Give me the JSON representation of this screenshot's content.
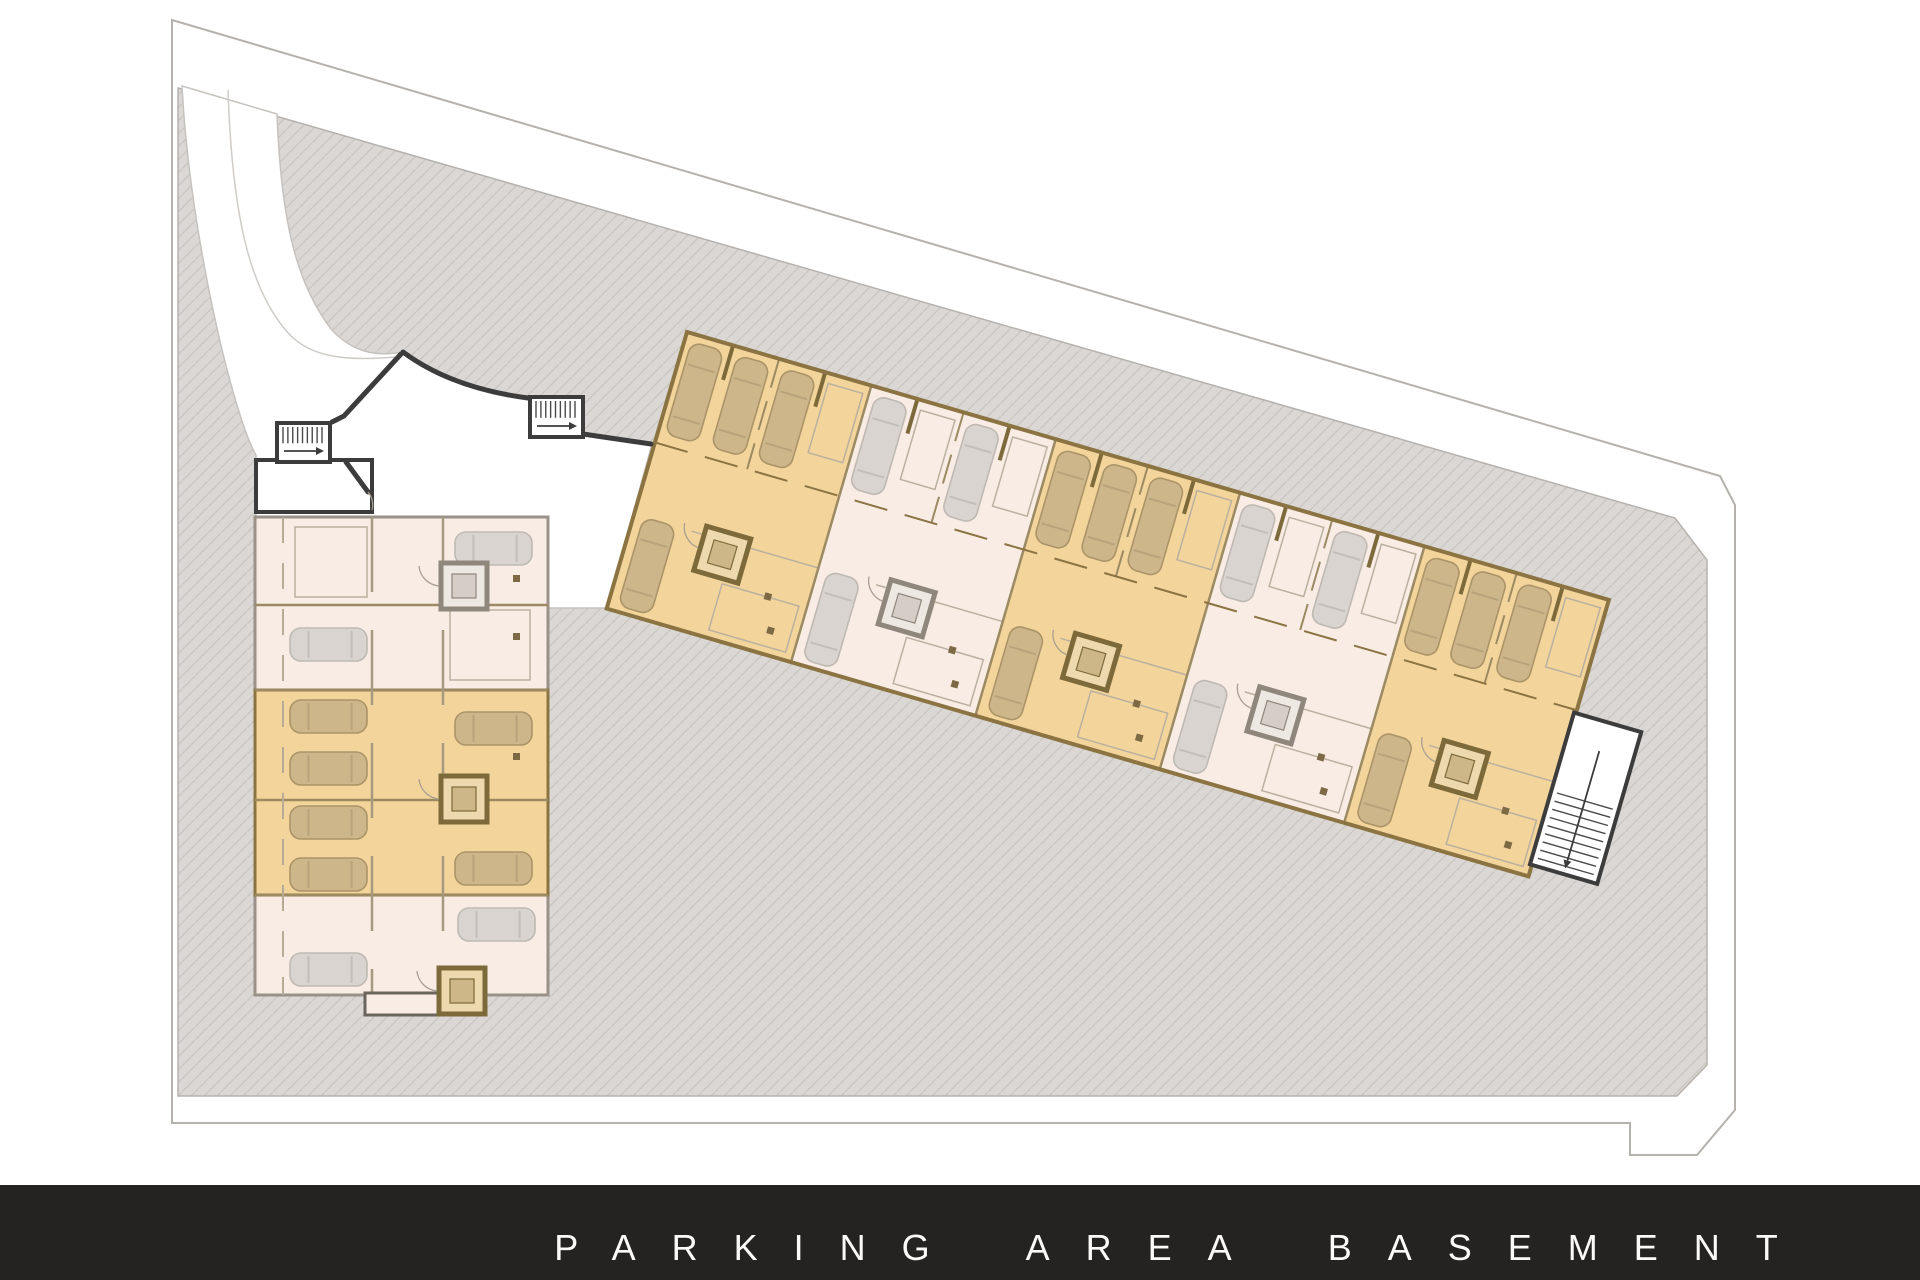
{
  "footer": {
    "title": "PARKING AREA BASEMENT"
  },
  "palette": {
    "boundary_line": "#b5b2ae",
    "site_base": "#dad7d4",
    "hatch_line": "#c9c6c2",
    "wall_dark": "#3c3c3c",
    "wall_tan": "#8b7442",
    "wall_gray": "#9a9189",
    "unit_orange": "#f3d49b",
    "unit_pink": "#f8ece4",
    "car_tan": "#cdb68a",
    "car_gray": "#d9d4cf",
    "footer_bg": "#242321",
    "footer_text": "#fafafa"
  },
  "plan": {
    "canvas": {
      "w": 1920,
      "h": 1280
    },
    "boundary_path": "M172,20 L1720,476 L1735,505 L1735,1110 L1697,1155 L1630,1155 L1630,1123 L172,1123 Z",
    "site_path": "M178,88 L1675,518 L1707,560 L1707,1065 L1677,1096 L178,1096 Z",
    "white_area_path": "M182,86 L277,114 C281,220 296,283 331,329 C352,352 375,357 403,352 C440,379 484,392 530,398 L583,434 L652,444 L607,608 L548,608 L548,517 L256,517 L256,455 C235,420 190,240 182,86 Z",
    "driveway_center_line": "M228,90 C232,210 248,290 290,335 C310,355 340,362 395,357",
    "walls_dark": [
      "M401,354 L344,416 L332,422",
      "M403,352 C438,378 482,392 528,398",
      "M583,434 L651,444"
    ],
    "entry_room": {
      "x": 256,
      "y": 460,
      "w": 116,
      "h": 52,
      "slant": "M346,462 L368,492",
      "door_arc": "M368,492 A20,20 0 0 1 372,510"
    },
    "stair_rooms": [
      {
        "x": 277,
        "y": 423,
        "w": 53,
        "h": 39
      },
      {
        "x": 530,
        "y": 397,
        "w": 53,
        "h": 40
      }
    ],
    "west_building": {
      "x": 255,
      "y": 517,
      "w": 293,
      "h": 478,
      "orange_band": {
        "y": 690,
        "h": 205
      },
      "row_lines": [
        605,
        690,
        800,
        895
      ],
      "aisle_lines": [
        372,
        443
      ],
      "divider_line": 283,
      "bump": {
        "x": 365,
        "y": 993,
        "w": 115,
        "h": 22
      },
      "elevators": [
        {
          "x": 441,
          "y": 563,
          "tone": "gray"
        },
        {
          "x": 441,
          "y": 776,
          "tone": "tan"
        },
        {
          "x": 439,
          "y": 968,
          "tone": "tan"
        }
      ],
      "cars": [
        {
          "x": 455,
          "y": 532,
          "tone": "gray"
        },
        {
          "x": 290,
          "y": 628,
          "tone": "gray"
        },
        {
          "x": 290,
          "y": 700,
          "tone": "tan"
        },
        {
          "x": 290,
          "y": 752,
          "tone": "tan"
        },
        {
          "x": 455,
          "y": 712,
          "tone": "tan"
        },
        {
          "x": 290,
          "y": 806,
          "tone": "tan"
        },
        {
          "x": 290,
          "y": 858,
          "tone": "tan"
        },
        {
          "x": 455,
          "y": 852,
          "tone": "tan"
        },
        {
          "x": 290,
          "y": 953,
          "tone": "gray"
        },
        {
          "x": 458,
          "y": 908,
          "tone": "gray"
        }
      ],
      "storage": [
        {
          "x": 295,
          "y": 527,
          "w": 72,
          "h": 70
        },
        {
          "x": 450,
          "y": 610,
          "w": 80,
          "h": 70
        }
      ],
      "columns": [
        [
          513,
          575
        ],
        [
          513,
          633
        ],
        [
          513,
          753
        ],
        [
          513,
          852
        ]
      ]
    },
    "main_building": {
      "origin": [
        687,
        332
      ],
      "angle": 16.2,
      "length": 960,
      "depth": 288,
      "section_w": 192,
      "top_row_h": 115,
      "sections": [
        {
          "fill": "orange",
          "cars_top": [
            7,
            55,
            103
          ],
          "storage_top": [
            150
          ]
        },
        {
          "fill": "pink",
          "cars_top": [
            7,
            103
          ],
          "storage_top": [
            54,
            150
          ]
        },
        {
          "fill": "orange",
          "cars_top": [
            7,
            55,
            103
          ],
          "storage_top": [
            150
          ]
        },
        {
          "fill": "pink",
          "cars_top": [
            7,
            103
          ],
          "storage_top": [
            54,
            150
          ]
        },
        {
          "fill": "orange",
          "cars_top": [
            7,
            55,
            103
          ],
          "storage_top": [
            150
          ]
        }
      ],
      "elevator": {
        "cx_rel": 96,
        "y": 181
      },
      "car_low": {
        "x": 10,
        "y": 190
      },
      "storage_low": [
        {
          "x": 104,
          "y": 232,
          "w": 80,
          "h": 48
        }
      ],
      "columns_low": [
        [
          148,
          228
        ],
        [
          160,
          260
        ]
      ],
      "stair_wing": {
        "x": 958,
        "y": 118,
        "w": 70,
        "h": 158
      }
    }
  }
}
